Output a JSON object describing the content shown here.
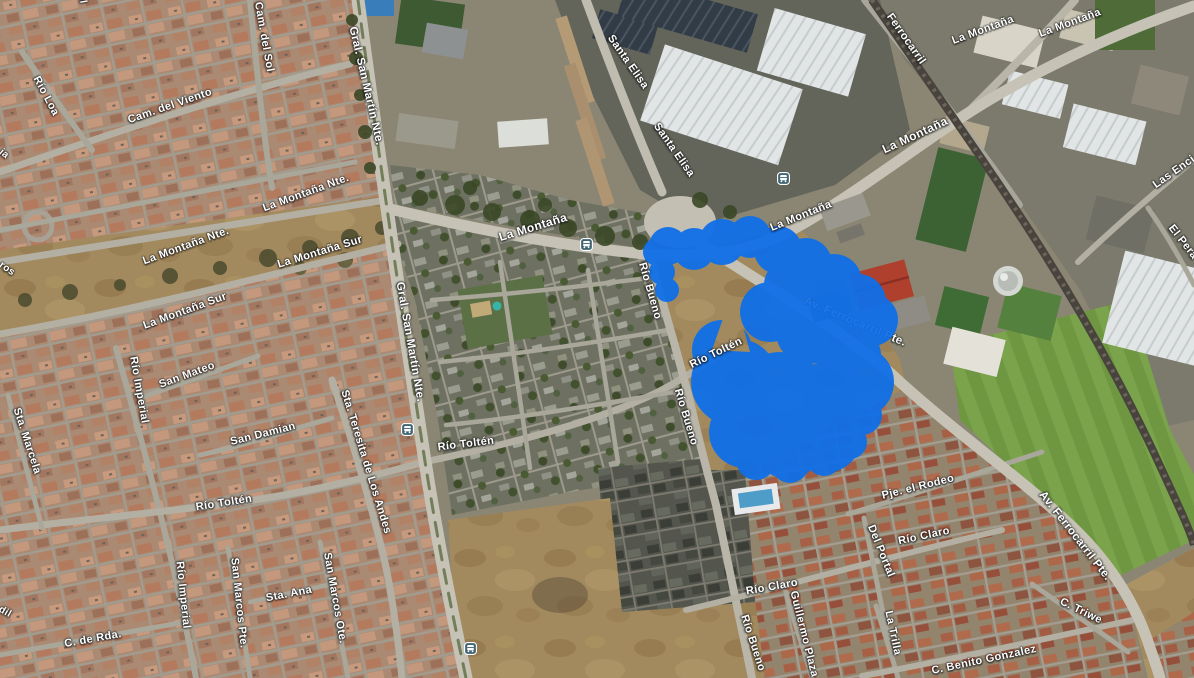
{
  "map": {
    "type": "satellite-map",
    "highlight_color": "#0F6FE8",
    "bus_icon_color": "#3F6474",
    "road_labels": [
      {
        "text": "Cam. del Sol",
        "x": 264,
        "y": 37,
        "rot": 80,
        "size": 11
      },
      {
        "text": "del Sol",
        "x": 80,
        "y": -14,
        "rot": 80,
        "size": 10
      },
      {
        "text": "Río Loa",
        "x": 46,
        "y": 96,
        "rot": 62,
        "size": 11
      },
      {
        "text": "Cam. del Viento",
        "x": 170,
        "y": 106,
        "rot": -19,
        "size": 11
      },
      {
        "text": "Gral. San Martín Nte.",
        "x": 366,
        "y": 86,
        "rot": 77,
        "size": 11.5
      },
      {
        "text": "Gral. San Martín Nte.",
        "x": 410,
        "y": 342,
        "rot": 80,
        "size": 11.5
      },
      {
        "text": "La Montaña Nte.",
        "x": 306,
        "y": 193,
        "rot": -20,
        "size": 11
      },
      {
        "text": "La Montaña Nte.",
        "x": 186,
        "y": 246,
        "rot": -20,
        "size": 11
      },
      {
        "text": "La Montaña Sur",
        "x": 320,
        "y": 252,
        "rot": -17,
        "size": 11
      },
      {
        "text": "La Montaña Sur",
        "x": 185,
        "y": 311,
        "rot": -20,
        "size": 11
      },
      {
        "text": "ja",
        "x": 4,
        "y": 154,
        "rot": 40,
        "size": 10
      },
      {
        "text": "ros",
        "x": 7,
        "y": 269,
        "rot": 35,
        "size": 10
      },
      {
        "text": "Sta. Marcela",
        "x": 27,
        "y": 441,
        "rot": 72,
        "size": 11
      },
      {
        "text": "Río Imperial",
        "x": 139,
        "y": 390,
        "rot": 80,
        "size": 11
      },
      {
        "text": "San Mateo",
        "x": 187,
        "y": 375,
        "rot": -20,
        "size": 11
      },
      {
        "text": "San Damian",
        "x": 263,
        "y": 434,
        "rot": -14,
        "size": 11
      },
      {
        "text": "Sta. Teresita de Los Andes",
        "x": 366,
        "y": 462,
        "rot": 73,
        "size": 11
      },
      {
        "text": "Río Toltén",
        "x": 224,
        "y": 503,
        "rot": -9,
        "size": 11
      },
      {
        "text": "Río Toltén",
        "x": 466,
        "y": 444,
        "rot": -7,
        "size": 11
      },
      {
        "text": "Río Toltén",
        "x": 716,
        "y": 353,
        "rot": -26,
        "size": 11
      },
      {
        "text": "Río Imperial",
        "x": 183,
        "y": 595,
        "rot": 84,
        "size": 11
      },
      {
        "text": "San Marcos Pte.",
        "x": 239,
        "y": 603,
        "rot": 84,
        "size": 11
      },
      {
        "text": "Sta. Ana",
        "x": 289,
        "y": 594,
        "rot": -11,
        "size": 11
      },
      {
        "text": "San Marcos Ote.",
        "x": 335,
        "y": 598,
        "rot": 80,
        "size": 11
      },
      {
        "text": "C. de Rda.",
        "x": 93,
        "y": 639,
        "rot": -10,
        "size": 11
      },
      {
        "text": "dil",
        "x": 5,
        "y": 612,
        "rot": 30,
        "size": 10
      },
      {
        "text": "Santa Elisa",
        "x": 628,
        "y": 62,
        "rot": 55,
        "size": 11
      },
      {
        "text": "Santa Elisa",
        "x": 674,
        "y": 150,
        "rot": 55,
        "size": 11
      },
      {
        "text": "Ferrocarril",
        "x": 906,
        "y": 39,
        "rot": 55,
        "size": 11
      },
      {
        "text": "La Montaña",
        "x": 533,
        "y": 227,
        "rot": -17,
        "size": 12
      },
      {
        "text": "La Montaña",
        "x": 801,
        "y": 216,
        "rot": -22,
        "size": 11
      },
      {
        "text": "La Montaña",
        "x": 915,
        "y": 135,
        "rot": -25,
        "size": 12
      },
      {
        "text": "La Montaña",
        "x": 983,
        "y": 30,
        "rot": -20,
        "size": 11
      },
      {
        "text": "La Montaña",
        "x": 1070,
        "y": 23,
        "rot": -20,
        "size": 11
      },
      {
        "text": "Las Enci",
        "x": 1174,
        "y": 172,
        "rot": -35,
        "size": 11
      },
      {
        "text": "El Pera",
        "x": 1183,
        "y": 242,
        "rot": 52,
        "size": 11
      },
      {
        "text": "Av. Ferrocarril Pte.",
        "x": 855,
        "y": 322,
        "rot": 23,
        "size": 11.5,
        "layer": "under"
      },
      {
        "text": "Av. Ferrocarril Pte.",
        "x": 1075,
        "y": 536,
        "rot": 52,
        "size": 11.5
      },
      {
        "text": "Río Bueno",
        "x": 650,
        "y": 291,
        "rot": 74,
        "size": 11
      },
      {
        "text": "Río Bueno",
        "x": 686,
        "y": 417,
        "rot": 73,
        "size": 11
      },
      {
        "text": "Río Bueno",
        "x": 753,
        "y": 643,
        "rot": 72,
        "size": 11
      },
      {
        "text": "Río Claro",
        "x": 924,
        "y": 536,
        "rot": -12,
        "size": 11
      },
      {
        "text": "Río Claro",
        "x": 772,
        "y": 587,
        "rot": -10,
        "size": 11
      },
      {
        "text": "Pje. el Rodeo",
        "x": 918,
        "y": 487,
        "rot": -14,
        "size": 11
      },
      {
        "text": "Del Portal",
        "x": 881,
        "y": 551,
        "rot": 68,
        "size": 11
      },
      {
        "text": "Guillermo Plaza",
        "x": 804,
        "y": 634,
        "rot": 76,
        "size": 11
      },
      {
        "text": "La Trilla",
        "x": 893,
        "y": 633,
        "rot": 78,
        "size": 11
      },
      {
        "text": "C. Triwe",
        "x": 1081,
        "y": 611,
        "rot": 26,
        "size": 11
      },
      {
        "text": "C. Benito Gonzalez",
        "x": 984,
        "y": 660,
        "rot": -12,
        "size": 11
      }
    ],
    "transit_icons": [
      {
        "type": "bus-stop-icon",
        "x": 586,
        "y": 244
      },
      {
        "type": "bus-stop-icon",
        "x": 783,
        "y": 178
      },
      {
        "type": "bus-stop-icon",
        "x": 407,
        "y": 429
      },
      {
        "type": "bus-stop-icon",
        "x": 470,
        "y": 648
      }
    ]
  }
}
